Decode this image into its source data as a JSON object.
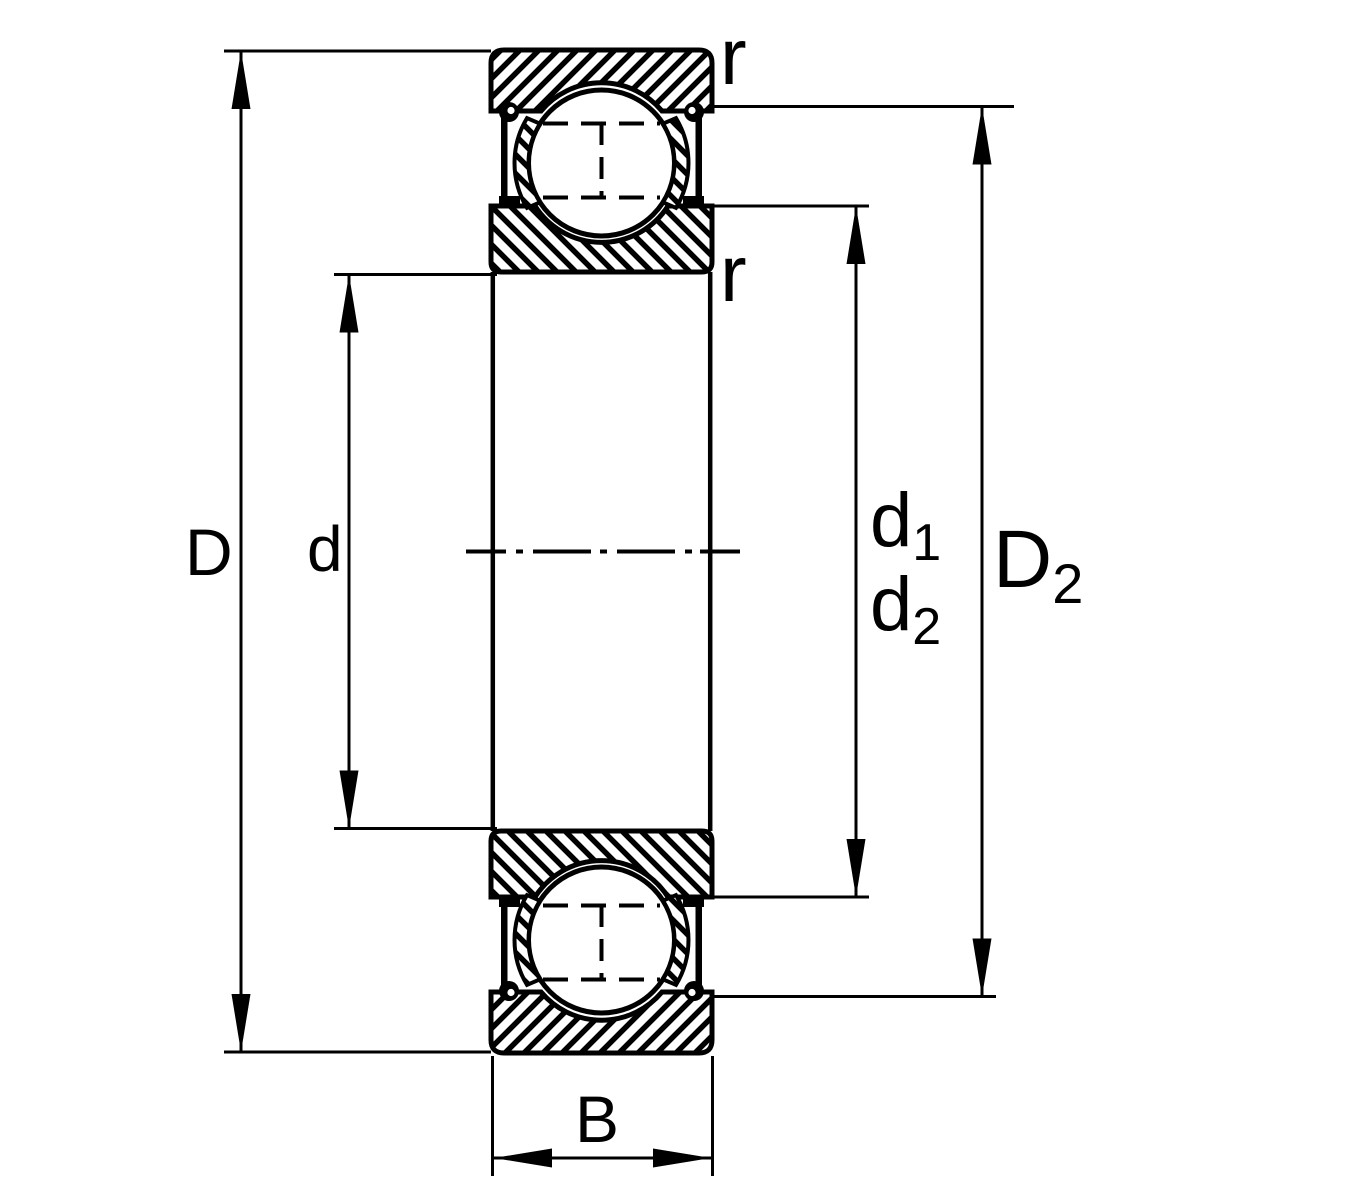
{
  "diagram": {
    "title": "deep-groove-ball-bearing-cross-section",
    "colors": {
      "line": "#000000",
      "background": "#ffffff"
    },
    "labels": {
      "outer_diameter": "D",
      "bore_diameter": "d",
      "width": "B",
      "corner_radius_outer": "r",
      "corner_radius_inner": "r",
      "land_diameter_1": {
        "base": "d",
        "sub": "1"
      },
      "land_diameter_2": {
        "base": "d",
        "sub": "2"
      },
      "recess_diameter": {
        "base": "D",
        "sub": "2"
      }
    }
  }
}
